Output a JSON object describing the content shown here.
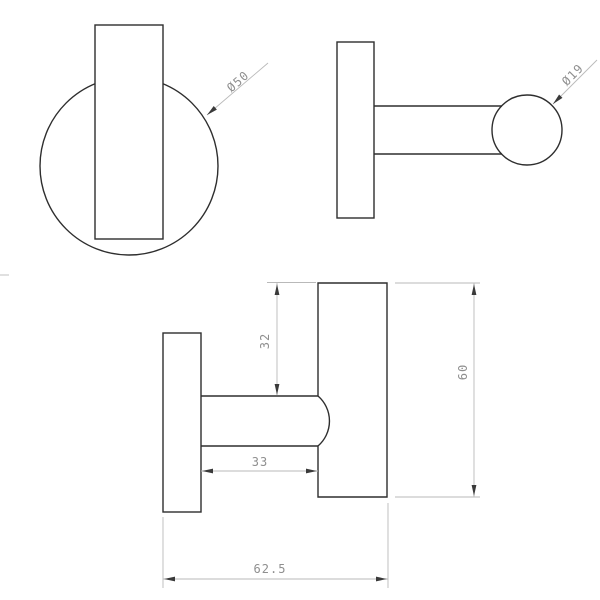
{
  "drawing": {
    "front_view": {
      "plate_diameter_label": "Ø50"
    },
    "top_view": {
      "tip_diameter_label": "Ø19"
    },
    "side_view": {
      "bar_offset_label": "32",
      "post_length_label": "33",
      "bar_length_label": "60",
      "overall_depth_label": "62.5"
    },
    "colors": {
      "geometry_line": "#2e2e2e",
      "dimension_line": "#b9b9b9",
      "dimension_text": "#8f8f8f",
      "arrowhead": "#3a3a3a",
      "background": "#ffffff"
    }
  }
}
